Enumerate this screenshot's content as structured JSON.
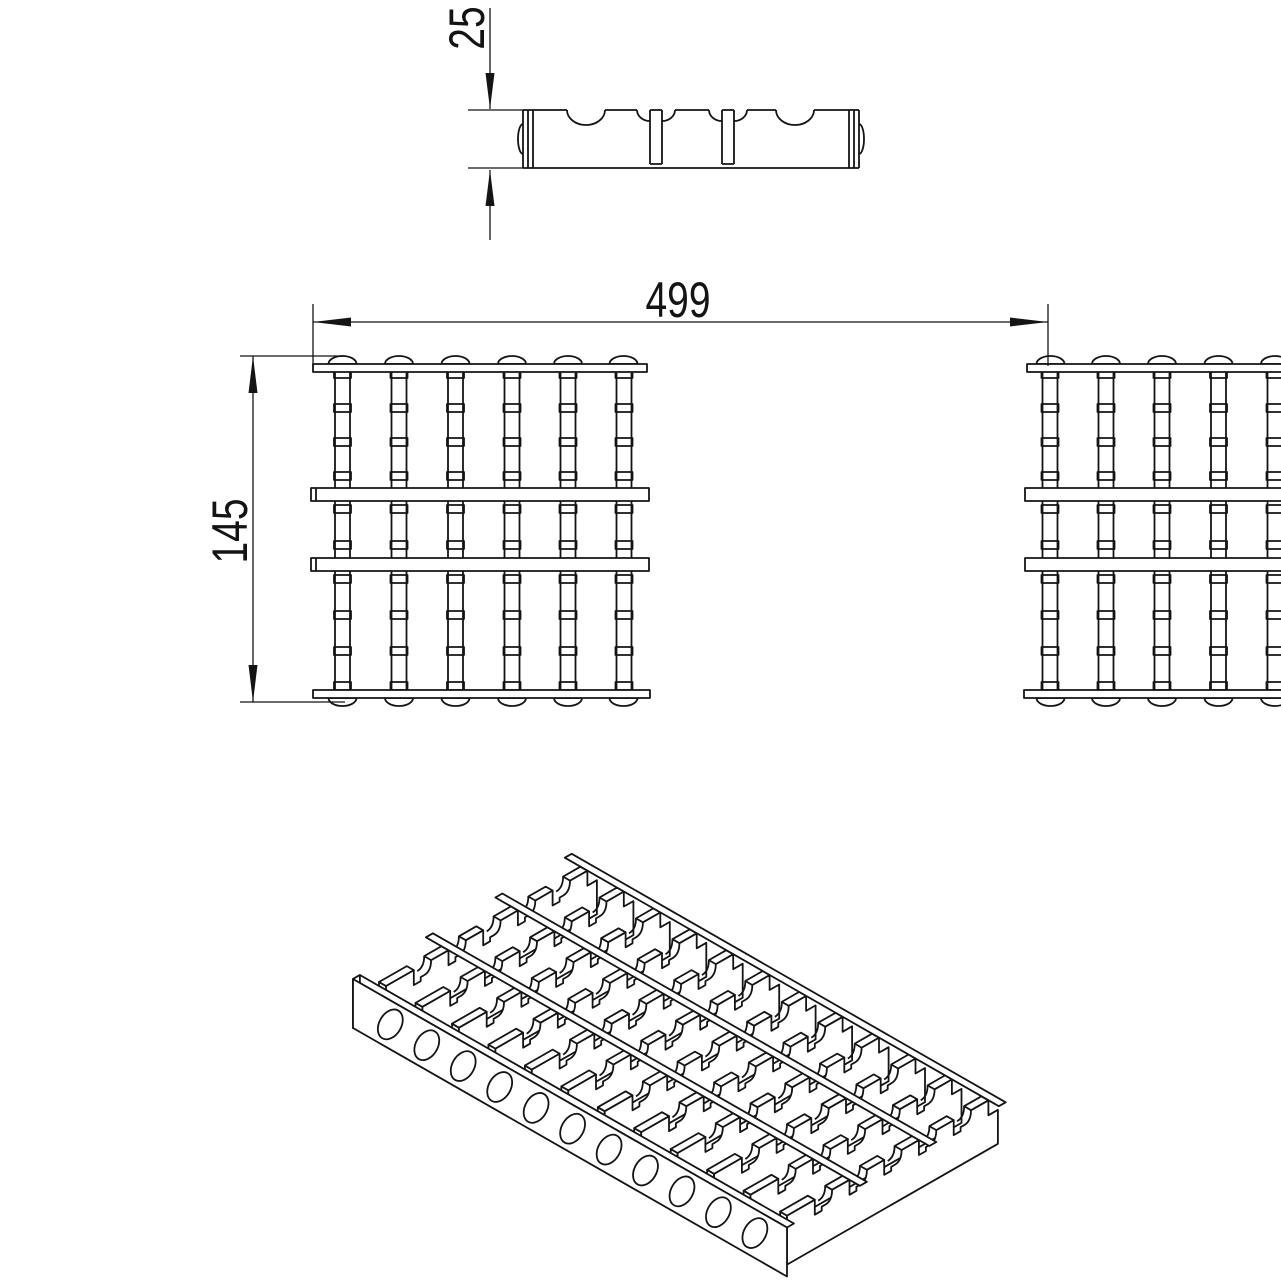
{
  "page": {
    "background_color": "#ffffff",
    "line_color": "#141414",
    "drawing_type": "grating technical drawing"
  },
  "dimension_labels": {
    "profile_height": "25",
    "overall_width": "499",
    "section_depth": "145"
  },
  "views": {
    "side_profile": {
      "top_notches": 2,
      "rail_slots": 2
    },
    "plan": {
      "sections": 2,
      "bearing_bars_per_section": 6,
      "intermediate_rails_per_section": 2,
      "edge_bumps_per_section": 6,
      "crossbar_ticks_per_bar": 10
    },
    "isometric": {
      "bearing_bars": 12,
      "teeth_per_bar": 6,
      "rails": 3,
      "drain_holes": 11
    }
  }
}
